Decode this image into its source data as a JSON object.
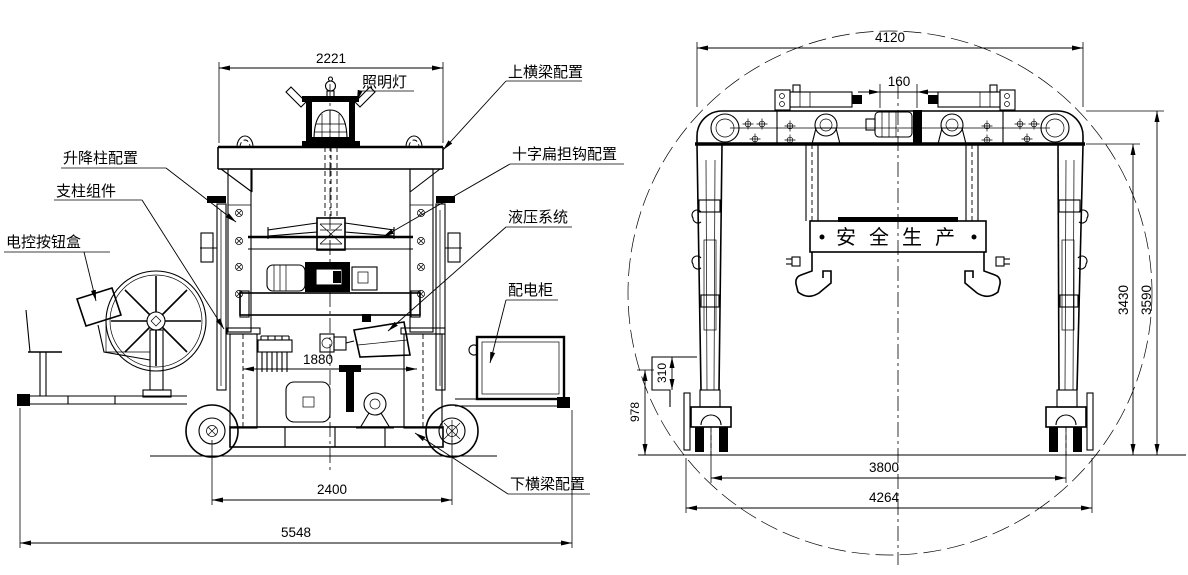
{
  "front": {
    "labels": {
      "lamp": "照明灯",
      "upper_beam": "上横梁配置",
      "lift_column": "升降柱配置",
      "support_column": "支柱组件",
      "control_box": "电控按钮盒",
      "cross_hook": "十字扁担钩配置",
      "hydraulic": "液压系统",
      "cabinet": "配电柜",
      "lower_beam": "下横梁配置"
    },
    "dims": {
      "top_width": "2221",
      "column_span": "1880",
      "wheel_base": "2400",
      "overall_length": "5548"
    }
  },
  "side": {
    "banner": "安全生产",
    "dims": {
      "beam_width": "4120",
      "center_offset": "160",
      "inner_height": "3430",
      "overall_height": "3590",
      "step_height": "310",
      "foot_height": "978",
      "rail_span": "3800",
      "overall_width": "4264"
    }
  },
  "style": {
    "line_color": "#000000",
    "background": "#ffffff"
  }
}
